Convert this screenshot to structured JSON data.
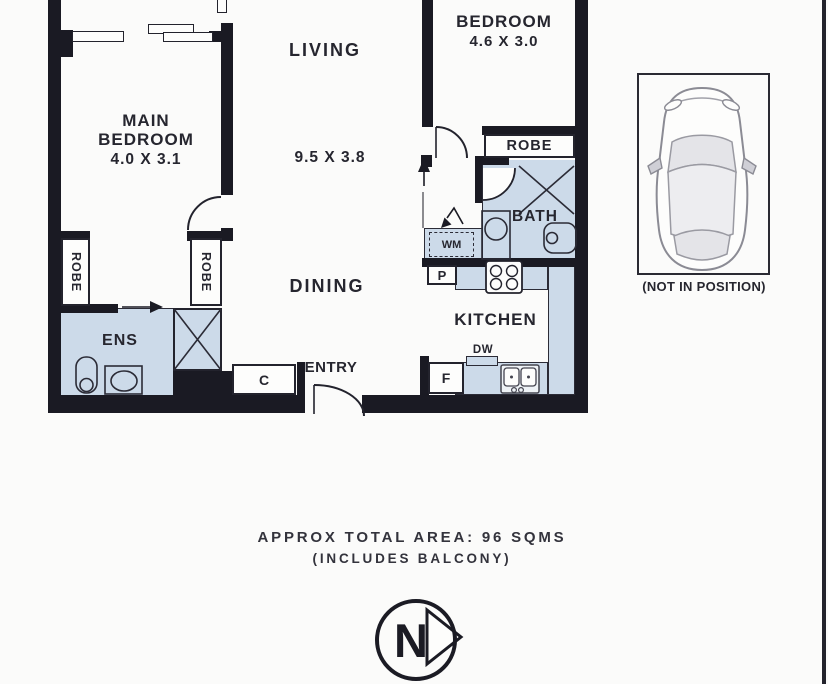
{
  "colors": {
    "wall": "#1a1a23",
    "room_fill": "#ccdae9",
    "line": "#23232d",
    "text": "#26262f"
  },
  "plan": {
    "main_bedroom_line1": "MAIN",
    "main_bedroom_line2": "BEDROOM",
    "main_bedroom_dims": "4.0 X 3.1",
    "living": "LIVING",
    "living_dims": "9.5 X 3.8",
    "dining": "DINING",
    "entry": "ENTRY",
    "ens": "ENS",
    "robe_left": "ROBE",
    "robe_right": "ROBE",
    "bedroom2": "BEDROOM",
    "bedroom2_dims": "4.6 X 3.0",
    "bedroom2_robe": "ROBE",
    "bath": "BATH",
    "kitchen": "KITCHEN",
    "wm": "WM",
    "pantry": "P",
    "dw": "DW",
    "fridge": "F",
    "cupboard": "C"
  },
  "car_space": {
    "caption": "(NOT IN POSITION)"
  },
  "footer": {
    "line1": "APPROX TOTAL AREA: 96 SQMS",
    "line2": "(INCLUDES BALCONY)"
  },
  "compass": {
    "label": "N"
  }
}
